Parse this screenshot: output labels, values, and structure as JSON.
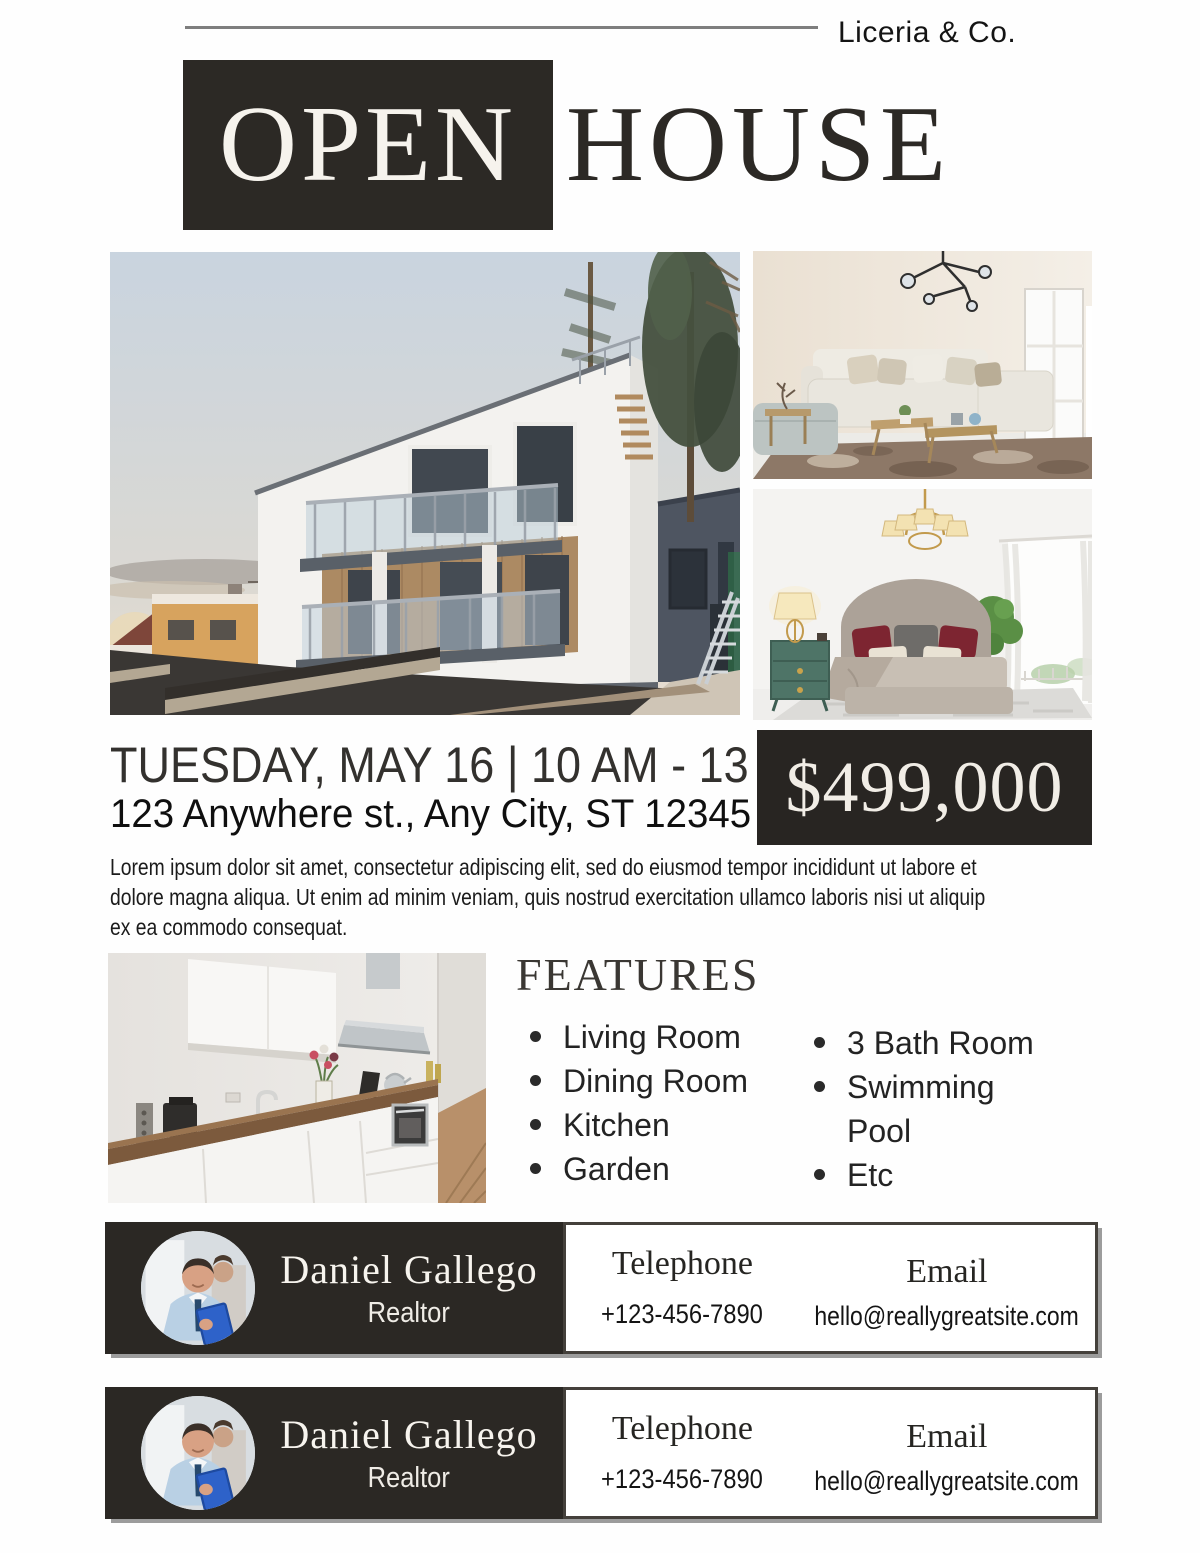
{
  "flyer": {
    "brand": "Liceria & Co.",
    "title": {
      "open": "OPEN",
      "house": "HOUSE"
    },
    "event": {
      "datetime": "TUESDAY, MAY 16 | 10 AM - 13 PM",
      "address": "123 Anywhere st., Any City, ST 12345",
      "price": "$499,000"
    },
    "description_lines": [
      "Lorem ipsum dolor sit amet, consectetur adipiscing elit, sed do eiusmod tempor incididunt ut labore et",
      "dolore magna aliqua. Ut enim ad minim veniam, quis nostrud exercitation ullamco laboris nisi ut aliquip",
      "ex ea commodo consequat."
    ],
    "features": {
      "heading": "FEATURES",
      "column1": [
        "Living Room",
        "Dining Room",
        "Kitchen",
        "Garden"
      ],
      "column2": [
        "3 Bath Room",
        "Swimming Pool",
        "Etc"
      ]
    },
    "photos": {
      "main": "modern-house-exterior",
      "top_right": "living-room",
      "bottom_right": "bedroom",
      "lower_left": "kitchen"
    },
    "agents": [
      {
        "name": "Daniel Gallego",
        "role": "Realtor",
        "phone_label": "Telephone",
        "phone": "+123-456-7890",
        "email_label": "Email",
        "email": "hello@reallygreatsite.com"
      },
      {
        "name": "Daniel Gallego",
        "role": "Realtor",
        "phone_label": "Telephone",
        "phone": "+123-456-7890",
        "email_label": "Email",
        "email": "hello@reallygreatsite.com"
      }
    ],
    "colors": {
      "accent_dark": "#2c2925",
      "page_bg": "#fefefe",
      "rule_gray": "#7e7e7e"
    }
  }
}
